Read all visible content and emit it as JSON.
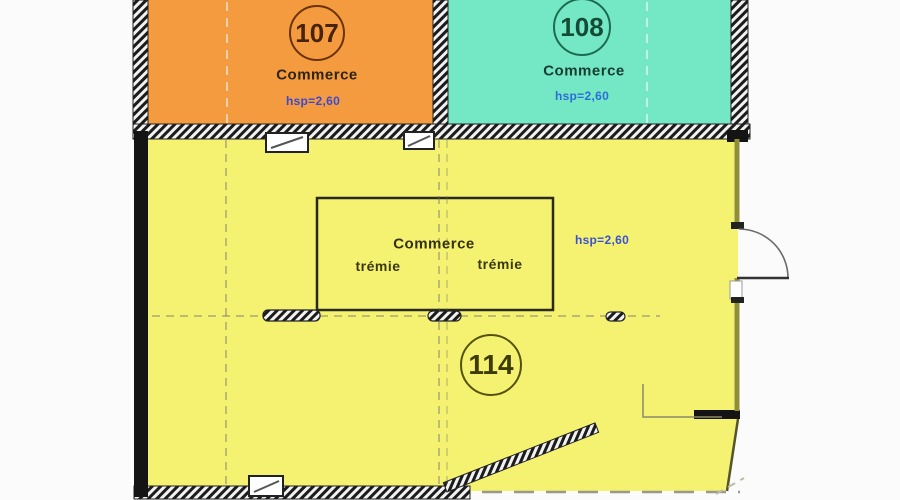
{
  "plan": {
    "type": "architectural-floor-plan",
    "background": "#fbfbfb",
    "wall_color": "#1a1a1a",
    "annotation_blue": "#3a52d4",
    "rooms": [
      {
        "number": "107",
        "name": "Commerce",
        "ceiling_height": "hsp=2,60",
        "fill": "#F59B3F"
      },
      {
        "number": "108",
        "name": "Commerce",
        "ceiling_height": "hsp=2,60",
        "fill": "#74E7C4"
      },
      {
        "number": "114",
        "name": "Commerce",
        "ceiling_height": "hsp=2,60",
        "fill": "#F5F171",
        "openings": [
          "trémie",
          "trémie"
        ]
      }
    ]
  }
}
